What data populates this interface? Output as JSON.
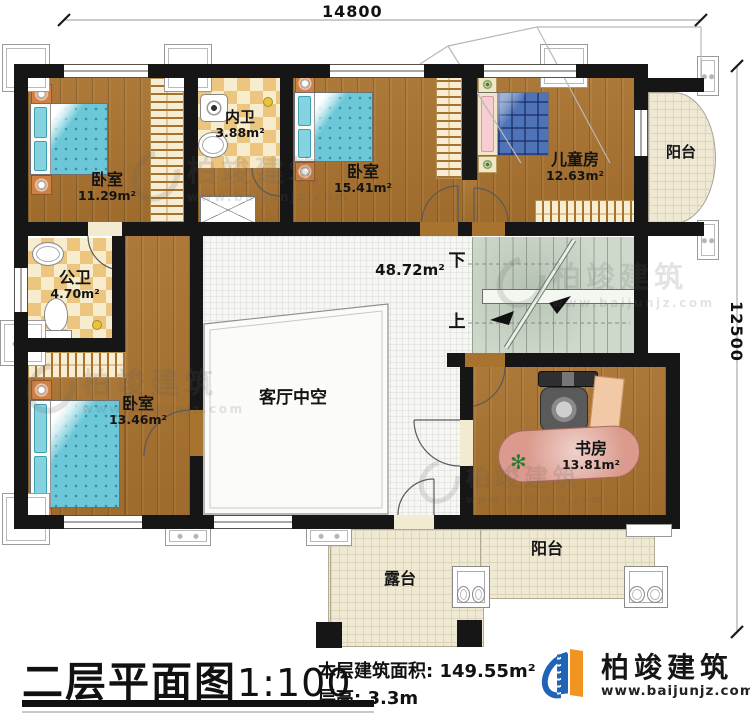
{
  "dimensions": {
    "width": "14800",
    "height": "12500"
  },
  "rooms": {
    "bedroom_tl": {
      "name": "卧室",
      "area": "11.29m²"
    },
    "inner_bath": {
      "name": "内卫",
      "area": "3.88m²"
    },
    "bedroom_tm": {
      "name": "卧室",
      "area": "15.41m²"
    },
    "kids_room": {
      "name": "儿童房",
      "area": "12.63m²"
    },
    "balcony_top": {
      "name": "阳台"
    },
    "public_bath": {
      "name": "公卫",
      "area": "4.70m²"
    },
    "bedroom_bl": {
      "name": "卧室",
      "area": "13.46m²"
    },
    "hall": {
      "area": "48.72m²"
    },
    "living_void": {
      "name": "客厅中空"
    },
    "study": {
      "name": "书房",
      "area": "13.81m²"
    },
    "balcony_bottom": {
      "name": "阳台"
    },
    "terrace": {
      "name": "露台"
    }
  },
  "stairs": {
    "down": "下",
    "up": "上"
  },
  "title_block": {
    "title": "二层平面图",
    "scale": "1:100",
    "area_label": "本层建筑面积:",
    "area_value": "149.55m²",
    "height_label": "层高:",
    "height_value": "3.3m"
  },
  "brand": {
    "name": "柏竣建筑",
    "website": "www.baijunjz.com"
  },
  "watermark": {
    "name": "柏竣建筑",
    "website": "www.baijunjz.com"
  },
  "colors": {
    "wall": "#161616",
    "wood_floor": "#a8722f",
    "tile": "#efe9d4",
    "checker": "#ecc57f",
    "stair": "#ccd6c8",
    "bed_teal": "#6cc8d9",
    "bed_plaid": "#4e73b7",
    "brand_blue": "#1f64b5",
    "brand_orange": "#f29422"
  }
}
